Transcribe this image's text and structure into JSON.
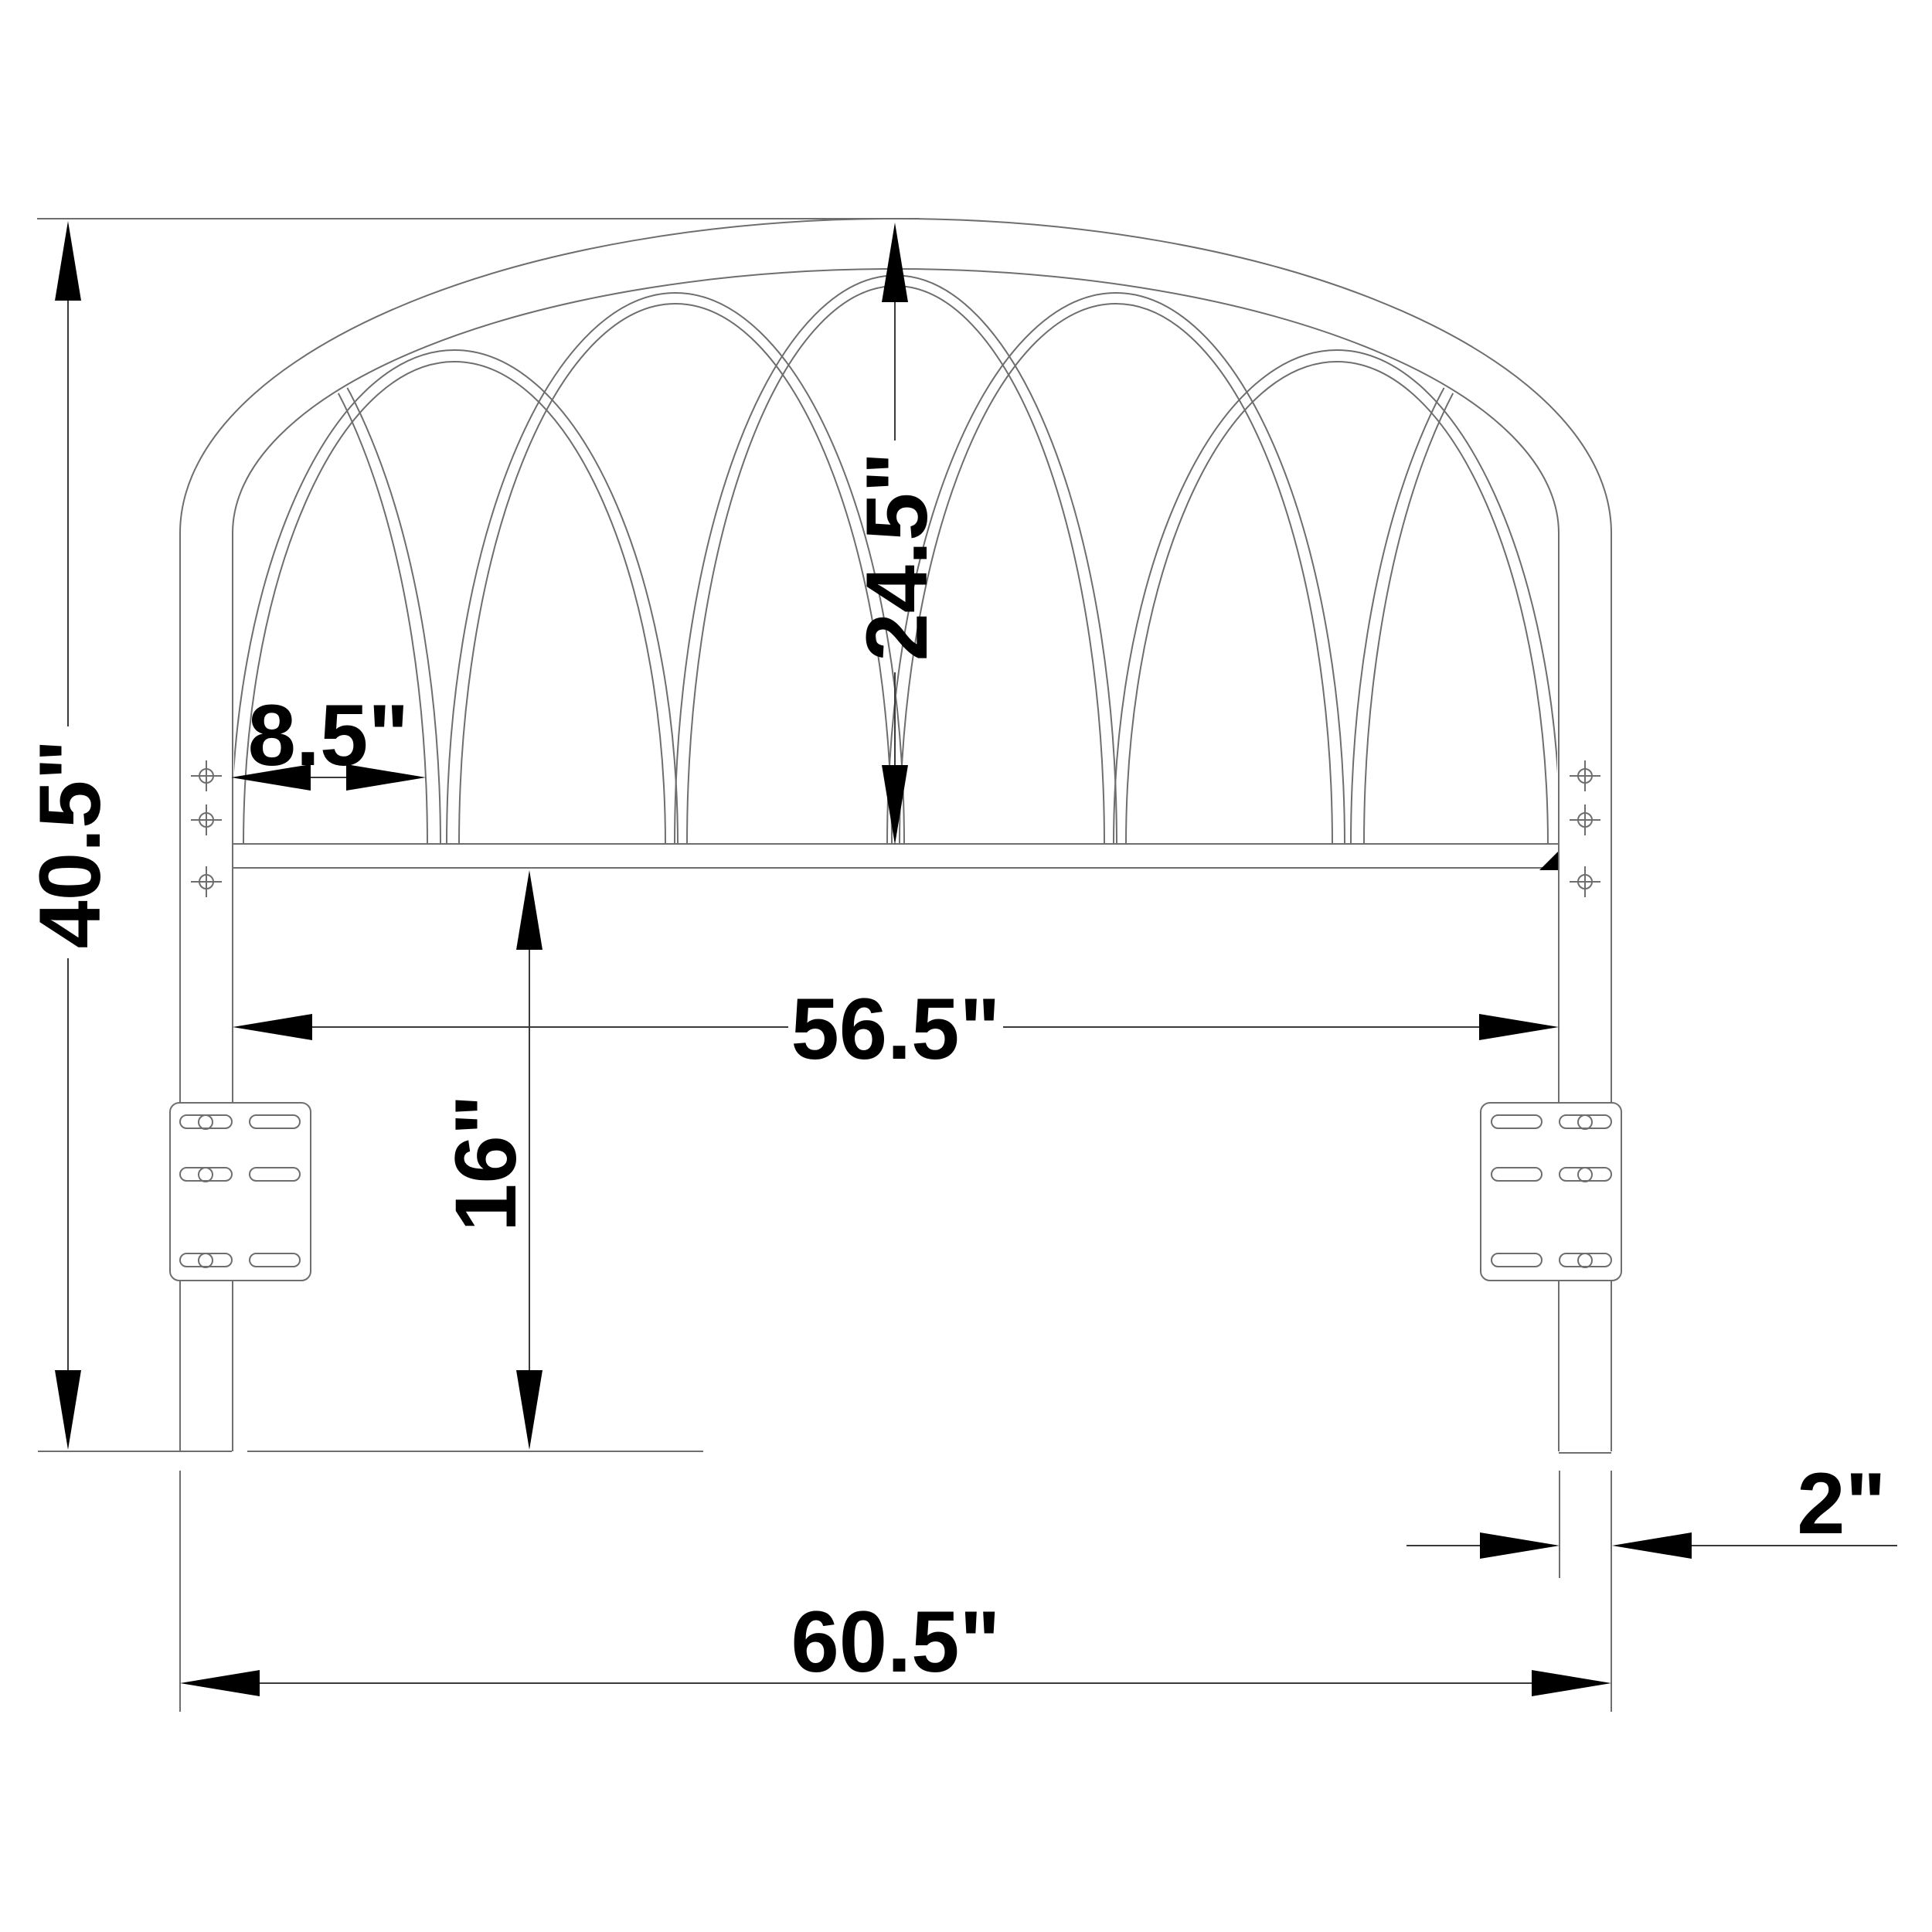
{
  "page": {
    "background": "#ffffff"
  },
  "drawing": {
    "subject": "Arched metal headboard with gothic tracery, front elevation dimension drawing",
    "style": "CAD line drawing",
    "units": "inches",
    "line_color": "#6e6e6e",
    "annotation_color": "#000000",
    "structure": {
      "tracery_arch_count": 5,
      "mounting_plate_count": 2,
      "slots_per_plate": 6,
      "screw_marks_per_leg": 3
    }
  },
  "dimensions": {
    "overall_height": {
      "label": "40.5\"",
      "orientation": "vertical",
      "location": "left edge, top of arch to bottom of legs"
    },
    "panel_height": {
      "label": "24.5\"",
      "orientation": "vertical",
      "location": "center, top of arch to crossbar"
    },
    "arch_spacing": {
      "label": "8.5\"",
      "orientation": "horizontal",
      "location": "upper left, leg to first arch foot"
    },
    "inner_width": {
      "label": "56.5\"",
      "orientation": "horizontal",
      "location": "between inner faces of legs"
    },
    "leg_height": {
      "label": "16\"",
      "orientation": "vertical",
      "location": "crossbar to floor"
    },
    "leg_width": {
      "label": "2\"",
      "orientation": "horizontal",
      "location": "right leg thickness"
    },
    "overall_width": {
      "label": "60.5\"",
      "orientation": "horizontal",
      "location": "bottom, outer faces of legs"
    }
  }
}
